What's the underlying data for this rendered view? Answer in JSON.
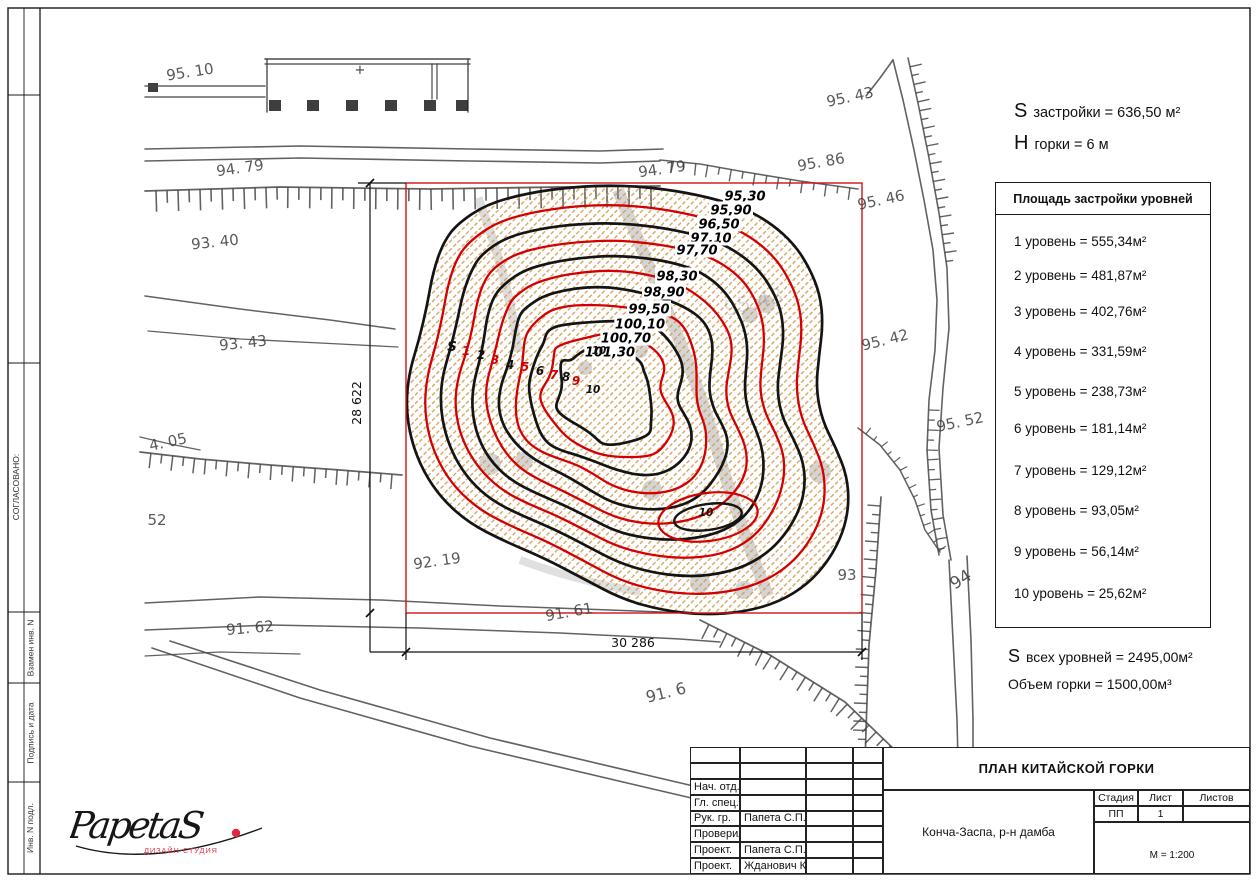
{
  "header_stats": {
    "s_prefix": "S",
    "s_rest": "застройки = 636,50 м²",
    "h_prefix": "Н",
    "h_rest": "горки = 6 м"
  },
  "levels_table": {
    "title": "Площадь застройки уровней горки",
    "rows": [
      "1 уровень = 555,34м²",
      "2 уровень = 481,87м²",
      "3 уровень = 402,76м²",
      "4 уровень = 331,59м²",
      "5 уровень = 238,73м²",
      "6 уровень = 181,14м²",
      "7 уровень = 129,12м²",
      "8 уровень = 93,05м²",
      "9 уровень = 56,14м²",
      "10 уровень = 25,62м²"
    ]
  },
  "totals": {
    "s_prefix": "S",
    "s_rest": "всех уровней = 2495,00м²",
    "volume": "Объем горки = 1500,00м³"
  },
  "title_block": {
    "title": "ПЛАН КИТАЙСКОЙ ГОРКИ",
    "object": "Конча-Заспа, р-н дамба",
    "rows": [
      {
        "role": "",
        "name": ""
      },
      {
        "role": "",
        "name": ""
      },
      {
        "role": "Нач. отд.",
        "name": ""
      },
      {
        "role": "Гл. спец.",
        "name": ""
      },
      {
        "role": "Рук. гр.",
        "name": "Папета С.П."
      },
      {
        "role": "Проверил",
        "name": ""
      },
      {
        "role": "Проект.",
        "name": "Папета С.П."
      },
      {
        "role": "Проект.",
        "name": "Жданович К.С."
      }
    ],
    "stage_label": "Стадия",
    "sheet_label": "Лист",
    "sheets_label": "Листов",
    "stage": "ПП",
    "sheet": "1",
    "sheets": "",
    "scale": "М = 1:200"
  },
  "side_strip": {
    "top_label": "СОГЛАСОВАНО:",
    "bottom_labels": [
      "Взамен инв. N",
      "Подпись и дата",
      "Инв. N подл."
    ]
  },
  "logo": {
    "name": "PapetaS",
    "subtitle": "ДИЗАЙН-СТУДИЯ"
  },
  "map": {
    "red_outline_color": "#cf1212",
    "contour_black": "#141414",
    "contour_red": "#d40000",
    "hatch_color": "#cf9a52",
    "contour_labels": [
      {
        "t": "95,30",
        "x": 745,
        "y": 196
      },
      {
        "t": "95,90",
        "x": 731,
        "y": 210
      },
      {
        "t": "96,50",
        "x": 719,
        "y": 224
      },
      {
        "t": "97,10",
        "x": 711,
        "y": 238
      },
      {
        "t": "97,70",
        "x": 697,
        "y": 250
      },
      {
        "t": "98,30",
        "x": 677,
        "y": 276
      },
      {
        "t": "98,90",
        "x": 664,
        "y": 292
      },
      {
        "t": "99,50",
        "x": 649,
        "y": 309
      },
      {
        "t": "100,10",
        "x": 640,
        "y": 324
      },
      {
        "t": "100,70",
        "x": 626,
        "y": 338
      },
      {
        "t": "101,30",
        "x": 610,
        "y": 352
      }
    ],
    "level_markers": [
      {
        "t": "S",
        "x": 452,
        "y": 351,
        "c": "black"
      },
      {
        "t": "1",
        "x": 466,
        "y": 355,
        "c": "red"
      },
      {
        "t": "2",
        "x": 481,
        "y": 359,
        "c": "black"
      },
      {
        "t": "3",
        "x": 495,
        "y": 364,
        "c": "red"
      },
      {
        "t": "4",
        "x": 510,
        "y": 369,
        "c": "black"
      },
      {
        "t": "5",
        "x": 525,
        "y": 371,
        "c": "red"
      },
      {
        "t": "6",
        "x": 540,
        "y": 375,
        "c": "black"
      },
      {
        "t": "7",
        "x": 554,
        "y": 379,
        "c": "red"
      },
      {
        "t": "8",
        "x": 566,
        "y": 381,
        "c": "black"
      },
      {
        "t": "9",
        "x": 576,
        "y": 385,
        "c": "red"
      },
      {
        "t": "10",
        "x": 599,
        "y": 354,
        "c": "black"
      },
      {
        "t": "10",
        "x": 593,
        "y": 393,
        "c": "black"
      },
      {
        "t": "10",
        "x": 706,
        "y": 516,
        "c": "black"
      }
    ],
    "elevation_labels": [
      {
        "t": "95. 10",
        "x": 190,
        "y": 72,
        "r": -9
      },
      {
        "t": "94. 79",
        "x": 240,
        "y": 168,
        "r": -8
      },
      {
        "t": "93. 40",
        "x": 215,
        "y": 242,
        "r": -6
      },
      {
        "t": "93. 43",
        "x": 243,
        "y": 343,
        "r": -6
      },
      {
        "t": "4. 05",
        "x": 168,
        "y": 442,
        "r": -12
      },
      {
        "t": "52",
        "x": 157,
        "y": 520,
        "r": 0
      },
      {
        "t": "92. 19",
        "x": 437,
        "y": 561,
        "r": -8
      },
      {
        "t": "91. 62",
        "x": 250,
        "y": 628,
        "r": -5
      },
      {
        "t": "91. 61",
        "x": 569,
        "y": 612,
        "r": -10
      },
      {
        "t": "94. 79",
        "x": 662,
        "y": 169,
        "r": -8
      },
      {
        "t": "95. 43",
        "x": 850,
        "y": 97,
        "r": -12
      },
      {
        "t": "95. 86",
        "x": 821,
        "y": 162,
        "r": -10
      },
      {
        "t": "95. 46",
        "x": 881,
        "y": 200,
        "r": -12
      },
      {
        "t": "95. 42",
        "x": 885,
        "y": 340,
        "r": -14
      },
      {
        "t": "95. 52",
        "x": 960,
        "y": 422,
        "r": -12
      },
      {
        "t": "93",
        "x": 847,
        "y": 575,
        "r": 0
      },
      {
        "t": "94",
        "x": 961,
        "y": 580,
        "r": -32,
        "s": 17
      },
      {
        "t": "91. 6",
        "x": 666,
        "y": 693,
        "r": -14,
        "s": 16
      },
      {
        "t": "95.43",
        "x": 754,
        "y": 304,
        "r": -14,
        "s": 21,
        "o": 0.16
      }
    ],
    "plus_mark": {
      "t": "+",
      "x": 360,
      "y": 70
    },
    "dimensions": {
      "height_label": "28 622",
      "width_label": "30 286"
    }
  }
}
